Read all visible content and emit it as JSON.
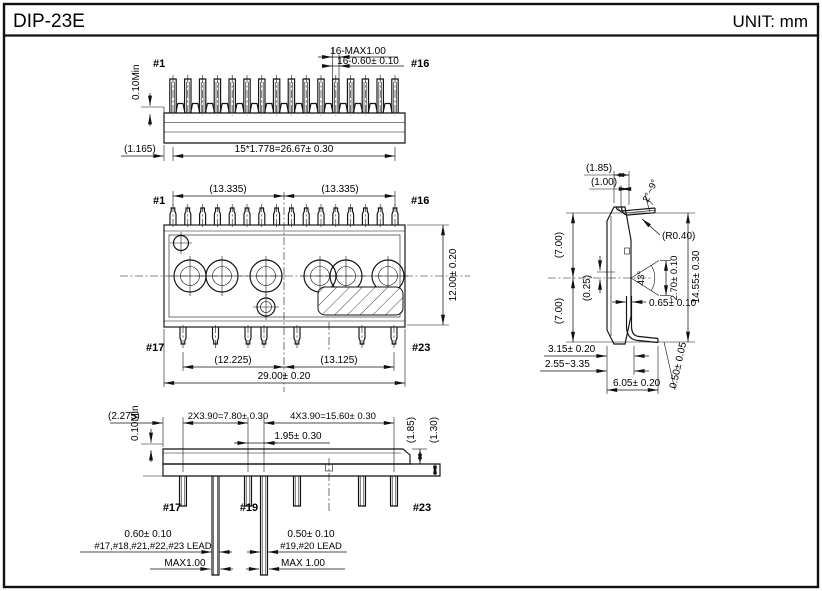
{
  "ink": "#111111",
  "paper": "#ffffff",
  "header": {
    "title": "DIP-23E",
    "unit": "UNIT: mm"
  },
  "top_view": {
    "pin_first": "#1",
    "pin_last": "#16",
    "dim_lead_tip_max": "16-MAX1.00",
    "dim_lead_width": "16-0.60± 0.10",
    "dim_standoff": "0.10Min",
    "dim_edge_to_pin1": "(1.165)",
    "dim_pitch_total": "15*1.778=26.67± 0.30"
  },
  "plan_view": {
    "pin_top_left": "#1",
    "pin_top_right": "#16",
    "pin_bottom_left": "#17",
    "pin_bottom_right": "#23",
    "dim_half_left": "(13.335)",
    "dim_half_right": "(13.335)",
    "dim_body_height": "12.00± 0.20",
    "dim_bottom_left_half": "(12.225)",
    "dim_bottom_right_half": "(13.125)",
    "dim_body_width": "29.00± 0.20"
  },
  "side_view": {
    "dim_top_offset_a": "(1.85)",
    "dim_top_offset_b": "(1.00)",
    "lead_tilt_angle": "2°~9°",
    "bend_radius": "(R0.40)",
    "dim_upper_half": "(7.00)",
    "dim_lower_half": "(7.00)",
    "dim_center_offset": "(0.25)",
    "wedge_angle": "43°",
    "dim_wedge_height": "2.70± 0.10",
    "dim_overall_height": "14.55± 0.30",
    "dim_lead_web": "0.65± 0.10",
    "dim_body_thickness": "3.15± 0.20",
    "dim_seating_range": "2.55~3.35",
    "dim_bottom_lead": "6.05± 0.20",
    "dim_lead_thickness": "0.50± 0.05"
  },
  "bottom_view": {
    "pin_first": "#17",
    "pin_middle": "#19",
    "pin_last": "#23",
    "dim_edge_to_pin17": "(2.275)",
    "dim_standoff": "0.10Min",
    "dim_pitch_left": "2X3.90=7.80± 0.30",
    "dim_pitch_right": "4X3.90=15.60± 0.30",
    "dim_pitch_center": "1.95± 0.30",
    "dim_step_a": "(1.85)",
    "dim_step_b": "(1.30)",
    "lead_wide": {
      "width": "0.60± 0.10",
      "pins": "#17,#18,#21,#22,#23 LEAD",
      "max": "MAX1.00"
    },
    "lead_narrow": {
      "width": "0.50± 0.10",
      "pins": "#19,#20 LEAD",
      "max": "MAX 1.00"
    }
  }
}
